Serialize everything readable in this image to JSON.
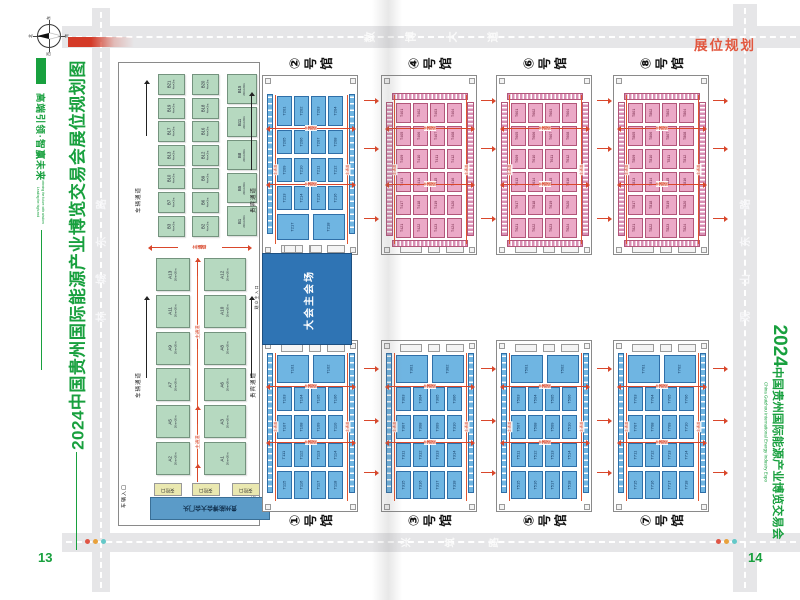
{
  "colors": {
    "brand_green": "#18a03e",
    "accent_red": "#e2573f",
    "channel_red": "#d9472b",
    "blue_booth": "#6fb5e2",
    "pink_booth": "#eba9c7",
    "green_booth": "#b6d9c0",
    "venue_blue": "#2f74b4",
    "road_gray": "#e6e6e8"
  },
  "header": {
    "planning_label": "展位规划"
  },
  "pages": {
    "left": "13",
    "right": "14"
  },
  "left_margin": {
    "title": "2024中国贵州国际能源产业博览交易会展位规划图",
    "slogan": "高端引领·智赢未来",
    "slogan_en1": "Leading the high-end",
    "slogan_en2": "winning the future with wisdom"
  },
  "right_margin": {
    "year": "2024",
    "title": "中国贵州国际能源产业博览交易会",
    "title_en": "China Guizhou International Energy Industry Expo"
  },
  "roads": {
    "top": "数博大道",
    "bottom": "兴筑路",
    "left": "林城东路",
    "right": "观山东路"
  },
  "compass": {
    "n": "北",
    "s": "南",
    "e": "东",
    "w": "西"
  },
  "venue": {
    "label": "大会主会场"
  },
  "channel_label": "主通道",
  "outdoor": {
    "labels": {
      "vehicle_channel": "车辆通道",
      "vip_channel": "贵宾通道",
      "vehicle_entrance": "车辆入口",
      "visitor_entrance": "观众主入口",
      "security": "安检口",
      "gate": "贵州能博会大会门头"
    },
    "zone_b": {
      "col1": [
        "B21",
        "B19",
        "B17",
        "B13",
        "B10",
        "B7",
        "B3"
      ],
      "col2": [
        "B20",
        "B18",
        "B16",
        "B12",
        "B9",
        "B6",
        "B2"
      ],
      "col3": [
        "B15",
        "B11",
        "B8",
        "B5",
        "B1"
      ],
      "size_small": "4m×3m",
      "size_large": "20m×20m"
    },
    "zone_a": {
      "rows": [
        [
          "A13",
          "A12"
        ],
        [
          "A11",
          "A10"
        ],
        [
          "A9",
          "A8"
        ],
        [
          "A7",
          "A6"
        ],
        [
          "A5",
          "A3"
        ],
        [
          "A2",
          "A1"
        ]
      ],
      "size": "20m×20m"
    }
  },
  "halls": [
    {
      "num": "②",
      "suffix": "号馆",
      "type": "blue",
      "col": 0,
      "row": "top",
      "booths": [
        "T201",
        "T202",
        "T203",
        "T204",
        "T205",
        "T206",
        "T207",
        "T208",
        "T209",
        "T210",
        "T211",
        "T212",
        "T213",
        "T214",
        "T215",
        "T216",
        "T217",
        "T218"
      ]
    },
    {
      "num": "④",
      "suffix": "号馆",
      "type": "pink",
      "col": 1,
      "row": "top",
      "booths": [
        "T401",
        "T402",
        "T403",
        "T404",
        "T405",
        "T406",
        "T407",
        "T408",
        "T409",
        "T410",
        "T411",
        "T412",
        "T413",
        "T414",
        "T415",
        "T416",
        "T417",
        "T418",
        "T419",
        "T420",
        "T421",
        "T422",
        "T423",
        "T424"
      ]
    },
    {
      "num": "⑥",
      "suffix": "号馆",
      "type": "pink",
      "col": 2,
      "row": "top",
      "booths": [
        "T601",
        "T602",
        "T603",
        "T604",
        "T605",
        "T606",
        "T607",
        "T608",
        "T609",
        "T610",
        "T611",
        "T612",
        "T613",
        "T614",
        "T615",
        "T616",
        "T617",
        "T618",
        "T619",
        "T620",
        "T621",
        "T622",
        "T623",
        "T624"
      ]
    },
    {
      "num": "⑧",
      "suffix": "号馆",
      "type": "pink",
      "col": 3,
      "row": "top",
      "booths": [
        "T801",
        "T802",
        "T803",
        "T804",
        "T805",
        "T806",
        "T807",
        "T808",
        "T809",
        "T810",
        "T811",
        "T812",
        "T813",
        "T814",
        "T815",
        "T816",
        "T817",
        "T818",
        "T819",
        "T820",
        "T821",
        "T822",
        "T823",
        "T824"
      ]
    },
    {
      "num": "①",
      "suffix": "号馆",
      "type": "blue",
      "col": 0,
      "row": "bottom",
      "booths": [
        "T101",
        "T102",
        "T103",
        "T104",
        "T105",
        "T106",
        "T107",
        "T108",
        "T109",
        "T110",
        "T111",
        "T112",
        "T113",
        "T114",
        "T115",
        "T116",
        "T117",
        "T118"
      ]
    },
    {
      "num": "③",
      "suffix": "号馆",
      "type": "blue",
      "col": 1,
      "row": "bottom",
      "booths": [
        "T301",
        "T302",
        "T303",
        "T304",
        "T305",
        "T306",
        "T307",
        "T308",
        "T309",
        "T310",
        "T311",
        "T312",
        "T313",
        "T314",
        "T315",
        "T316",
        "T317",
        "T318"
      ]
    },
    {
      "num": "⑤",
      "suffix": "号馆",
      "type": "blue",
      "col": 2,
      "row": "bottom",
      "booths": [
        "T501",
        "T502",
        "T503",
        "T504",
        "T505",
        "T506",
        "T507",
        "T508",
        "T509",
        "T510",
        "T511",
        "T512",
        "T513",
        "T514",
        "T515",
        "T516",
        "T517",
        "T518"
      ]
    },
    {
      "num": "⑦",
      "suffix": "号馆",
      "type": "blue",
      "col": 3,
      "row": "bottom",
      "booths": [
        "T701",
        "T702",
        "T703",
        "T704",
        "T705",
        "T706",
        "T707",
        "T708",
        "T709",
        "T710",
        "T711",
        "T712",
        "T713",
        "T714",
        "T715",
        "T716",
        "T717",
        "T718"
      ]
    }
  ]
}
